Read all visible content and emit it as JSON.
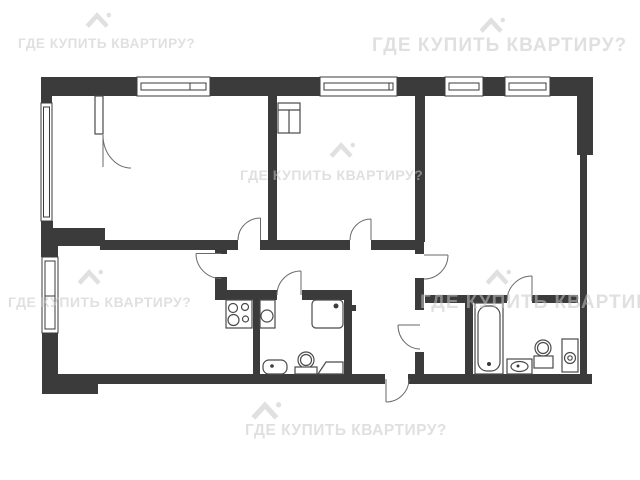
{
  "page": {
    "background": "#ffffff",
    "kind": "apartment-floor-plan-image"
  },
  "watermark": {
    "text": "ГДЕ КУПИТЬ КВАРТИРУ?",
    "logo_icon": "house-roof-icon",
    "color": "#c6c6c6",
    "instances": 6
  },
  "plan": {
    "wall_color": "#3b3b3b",
    "line_color": "#4a4a4a",
    "window_count": 6,
    "door_count": 9,
    "entrance_side": "bottom",
    "fixtures": [
      "stove-icon",
      "kitchen-sink-icon",
      "shower-tray-icon",
      "washbasin-icon",
      "toilet-icon",
      "bathtub-icon",
      "washbasin-icon",
      "toilet-icon",
      "washing-machine-icon"
    ]
  }
}
